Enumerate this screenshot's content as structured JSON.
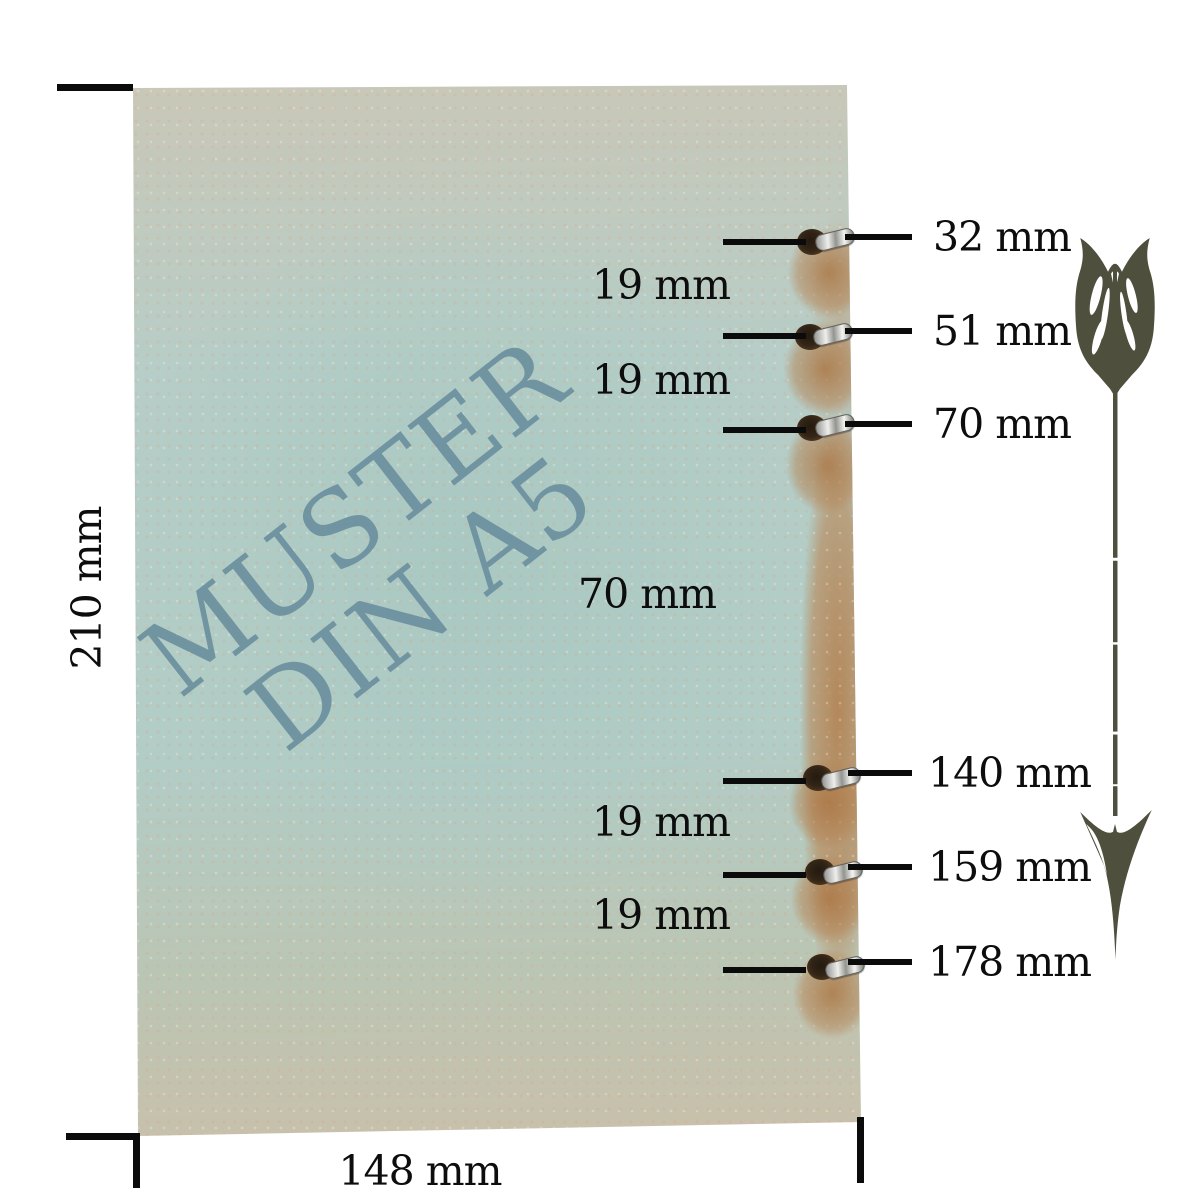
{
  "diagram": {
    "cover_title": {
      "line1": "MUSTER",
      "line2": "DIN A5"
    },
    "page_height_label": "210 mm",
    "page_width_label": "148 mm",
    "hole_position_labels": [
      "32 mm",
      "51 mm",
      "70 mm",
      "140 mm",
      "159 mm",
      "178 mm"
    ],
    "hole_gap_labels": [
      "19 mm",
      "19 mm",
      "70 mm",
      "19 mm",
      "19 mm"
    ],
    "icons": {
      "arrow": "arrow-down-icon",
      "eyelet": "eyelet-icon"
    },
    "colors": {
      "cover_center": "#b2ccc6",
      "cover_paper_beige": "#cdc5b3",
      "cover_worn_tan": "#b4885a",
      "title_text": "#688c9c",
      "dimension_lines": "#0b0b0b",
      "arrow": "#4f4f3d",
      "eyelet_metal": "#d9d9d7",
      "hole": "#332516"
    }
  }
}
